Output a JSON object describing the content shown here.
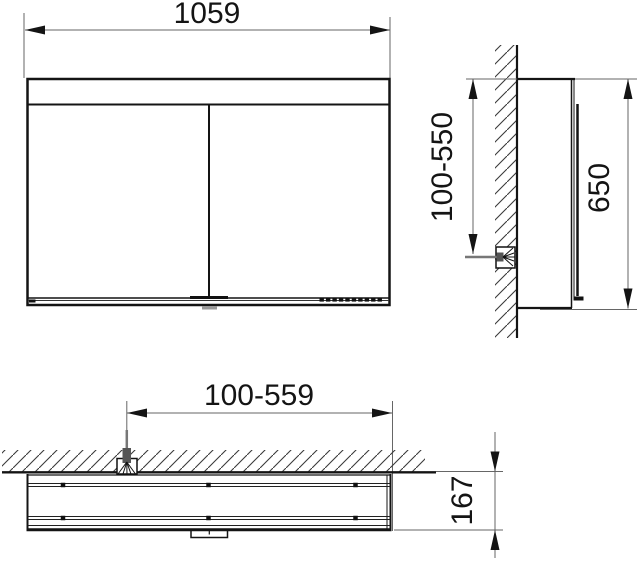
{
  "drawing": {
    "title": "mirror-cabinet-dimension-drawing",
    "views": {
      "front": {
        "name": "front elevation",
        "width_dim": "1059"
      },
      "side": {
        "name": "side section at wall",
        "mount_range_dim": "100-550",
        "height_dim": "650"
      },
      "bottom": {
        "name": "plan view at ceiling/wall",
        "cable_range_dim": "100-559",
        "depth_dim": "167"
      }
    },
    "colors": {
      "object_line": "#141414",
      "dim_line": "#666666",
      "cable": "#5a5a5a",
      "hatch": "#3a3a3a",
      "background": "#ffffff"
    }
  }
}
